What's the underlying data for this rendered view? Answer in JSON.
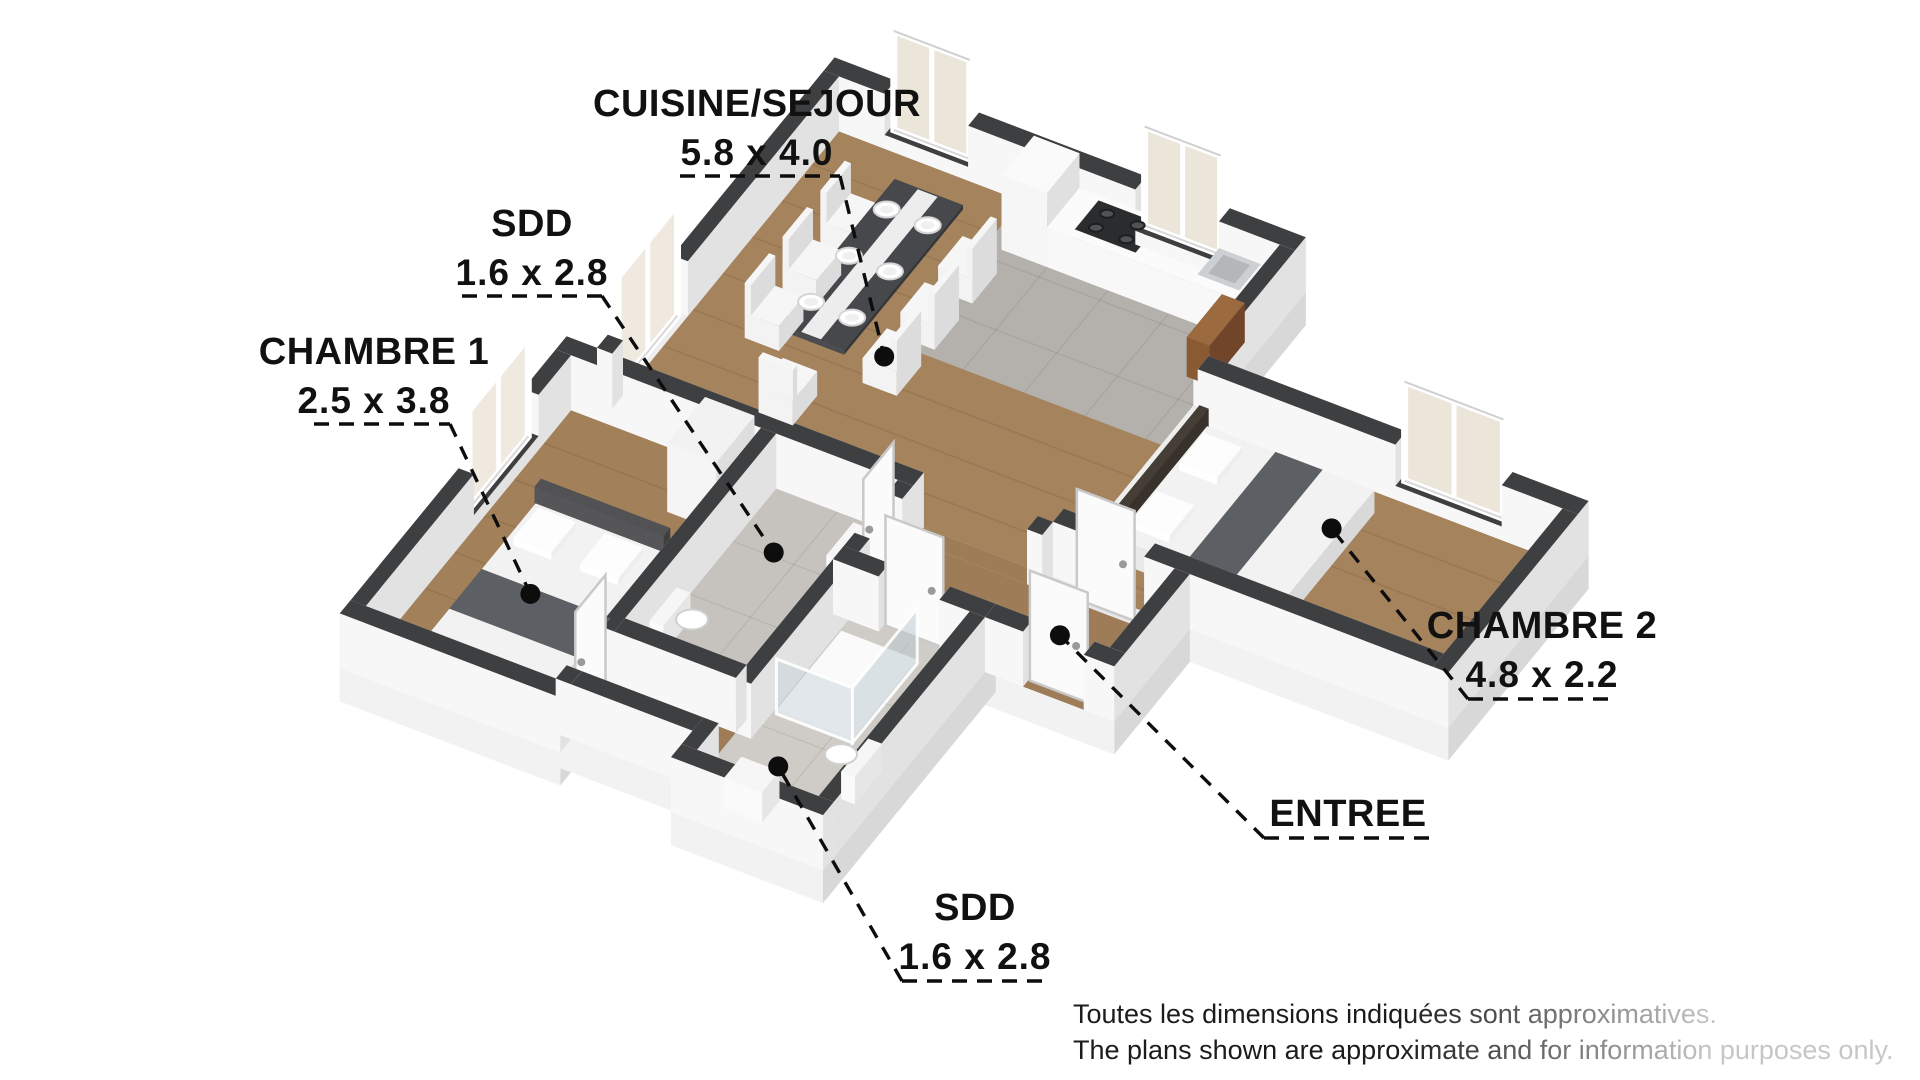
{
  "rooms": [
    {
      "name": "CUISINE/SEJOUR",
      "dims": "5.8 x 4.0"
    },
    {
      "name": "SDD",
      "dims": "1.6 x 2.8"
    },
    {
      "name": "CHAMBRE 1",
      "dims": "2.5 x 3.8"
    },
    {
      "name": "CHAMBRE 2",
      "dims": "4.8 x 2.2"
    },
    {
      "name": "ENTREE",
      "dims": ""
    },
    {
      "name": "SDD",
      "dims": "1.6 x 2.8"
    }
  ],
  "disclaimer": {
    "line1_fr": "Toutes les dimensions indiquées sont approximatives.",
    "line2_en": "The plans shown are approximate and for information purposes only."
  },
  "colors": {
    "wall_top": "#3e3f41",
    "wall_face_light": "#f7f7f7",
    "wall_face_shade": "#e2e2e2",
    "wood_floor": "#a5835d",
    "tile_floor": "#c6c3be",
    "kitchen_tile": "#b4b1ad",
    "cabinet_wood": "#8a5a33",
    "marker": "#0d0d0d"
  }
}
